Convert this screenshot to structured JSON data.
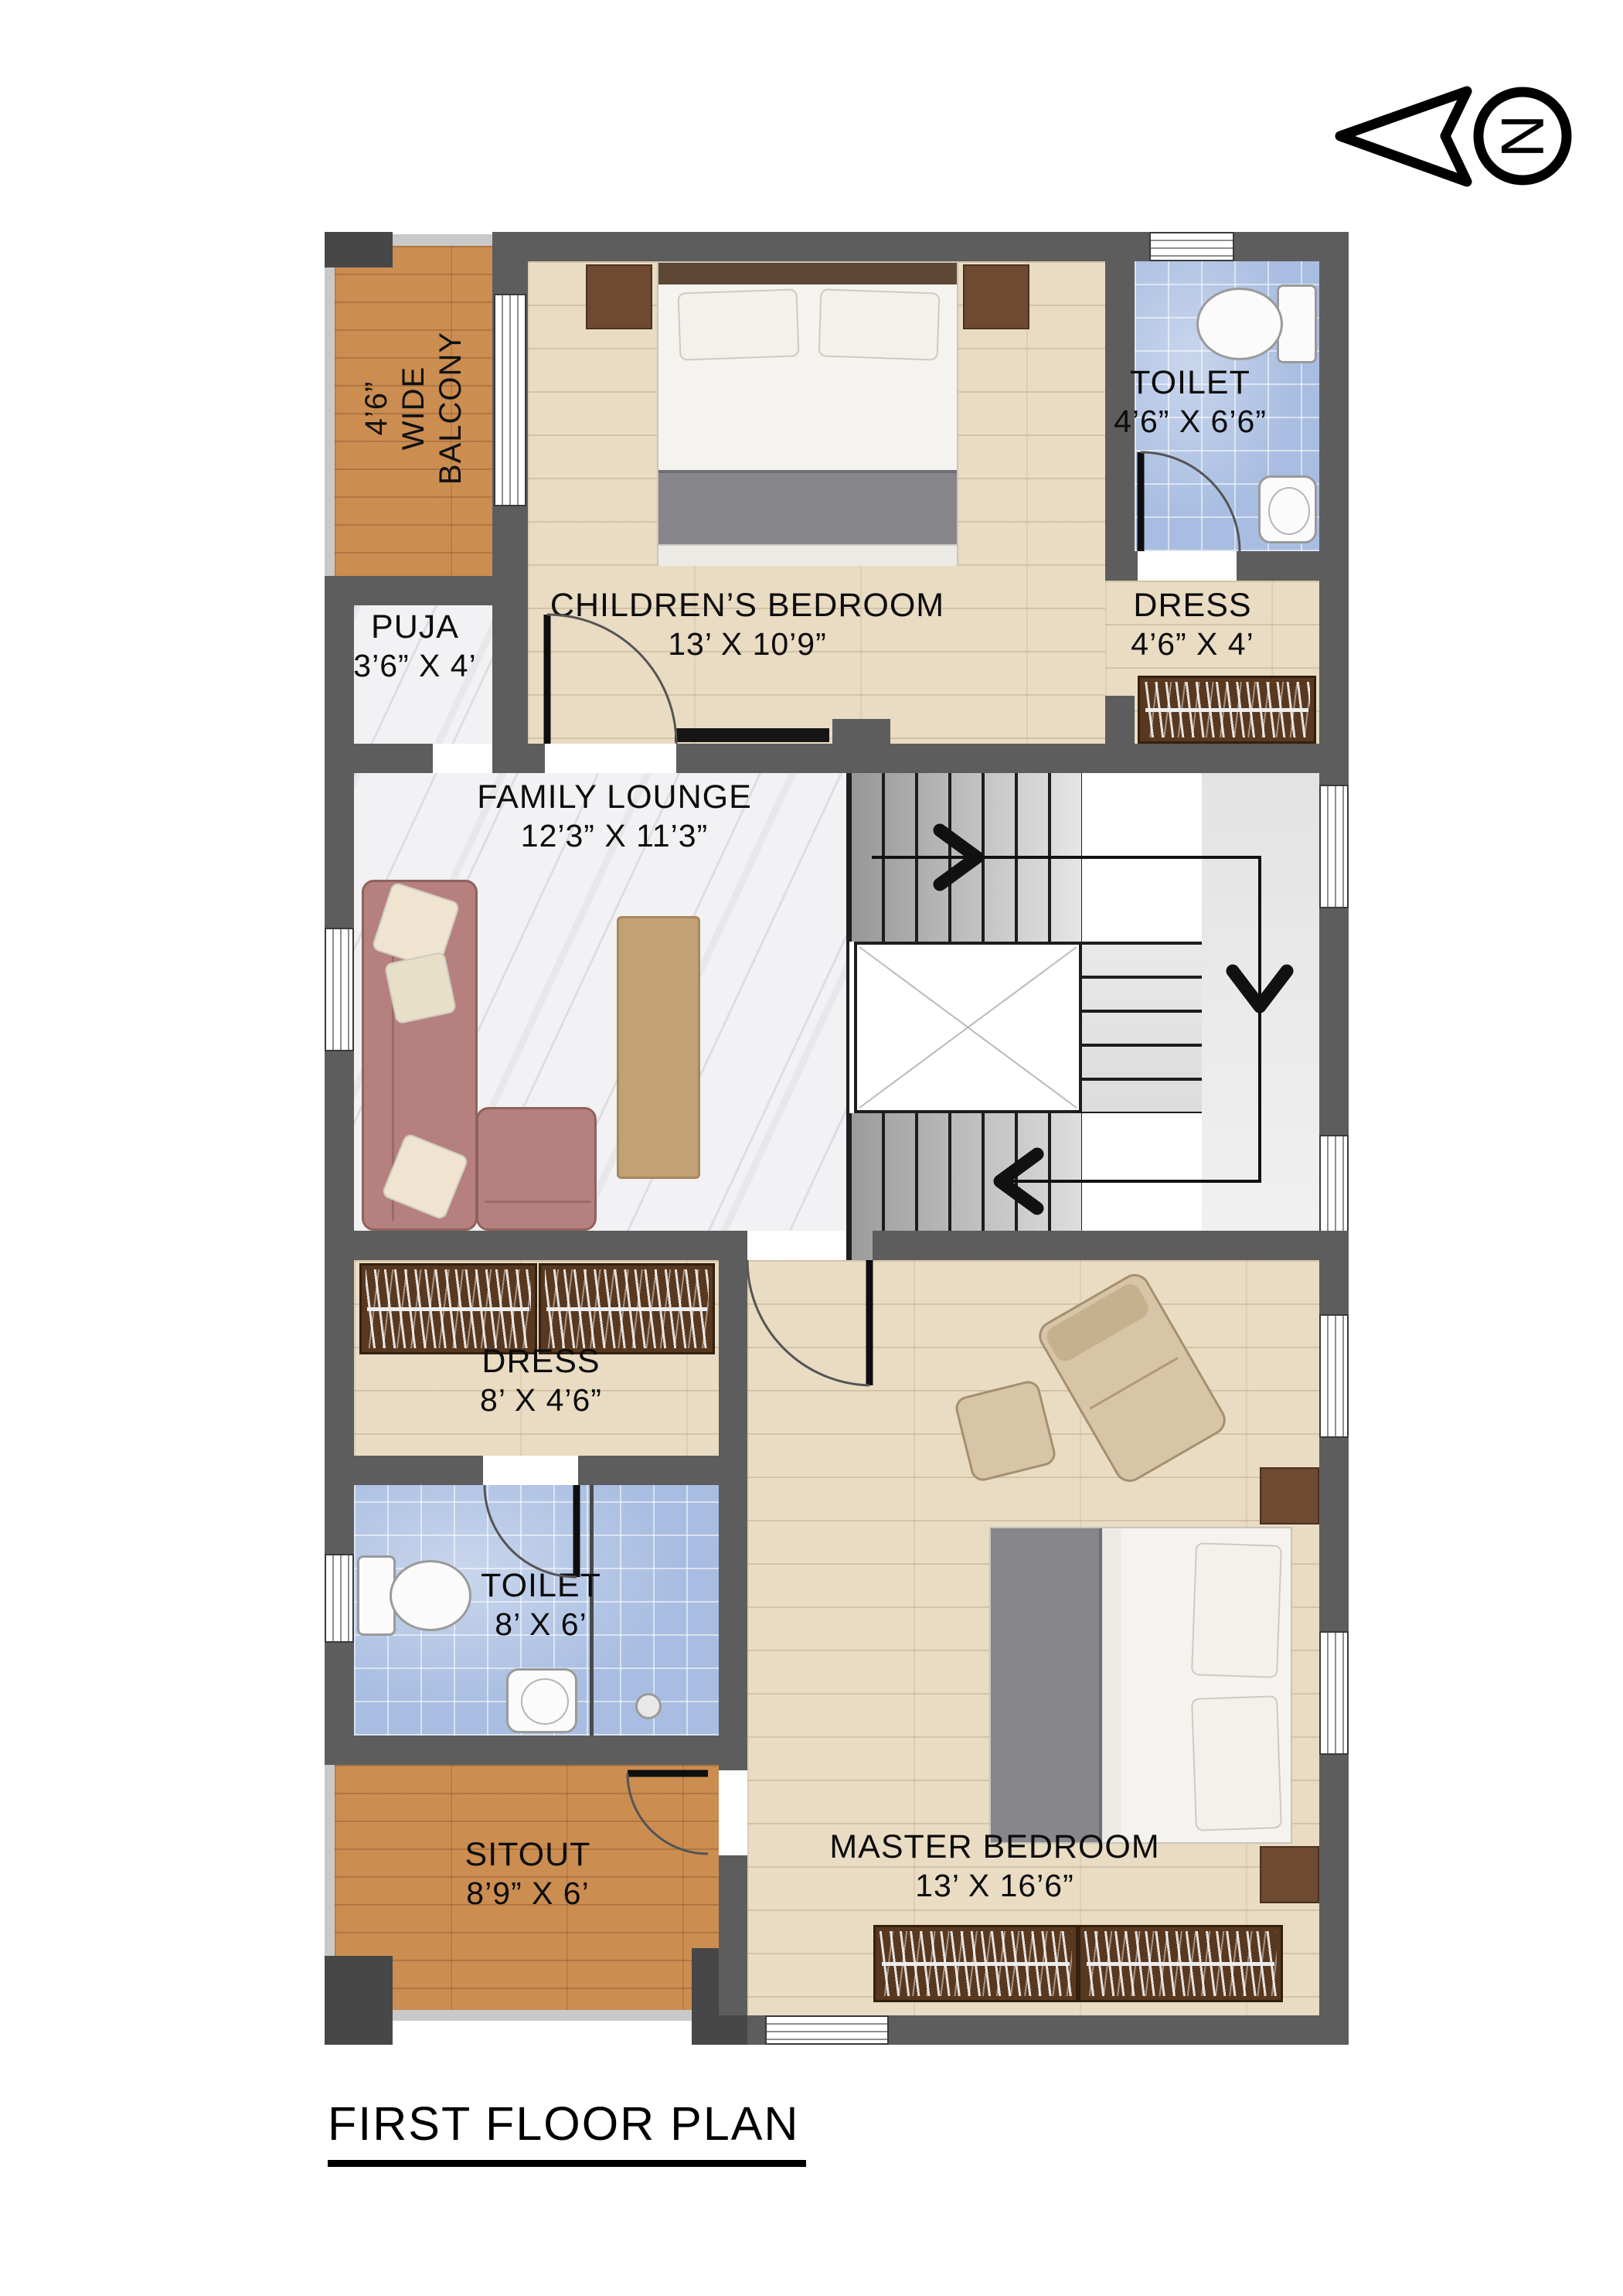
{
  "title": "FIRST FLOOR PLAN",
  "north": {
    "label": "N"
  },
  "rooms": [
    {
      "id": "balcony",
      "dims": "4’6”",
      "name_line1": "WIDE",
      "name_line2": "BALCONY",
      "name": "WIDE BALCONY",
      "floor": "warm-wood"
    },
    {
      "id": "puja",
      "name": "PUJA",
      "dims": "3’6” X 4’",
      "floor": "marble"
    },
    {
      "id": "childrens-bedroom",
      "name": "CHILDREN’S BEDROOM",
      "dims": "13’ X 10’9”",
      "floor": "light-wood"
    },
    {
      "id": "toilet-upper",
      "name": "TOILET",
      "dims": "4’6” X 6’6”",
      "floor": "blue-tile"
    },
    {
      "id": "dress-upper",
      "name": "DRESS",
      "dims": "4’6” X 4’",
      "floor": "light-wood"
    },
    {
      "id": "family-lounge",
      "name": "FAMILY LOUNGE",
      "dims": "12’3” X 11’3”",
      "floor": "marble"
    },
    {
      "id": "dress-lower",
      "name": "DRESS",
      "dims": "8’ X 4’6”",
      "floor": "light-wood"
    },
    {
      "id": "toilet-lower",
      "name": "TOILET",
      "dims": "8’ X 6’",
      "floor": "blue-tile"
    },
    {
      "id": "sitout",
      "name": "SITOUT",
      "dims": "8’9” X 6’",
      "floor": "warm-wood"
    },
    {
      "id": "master-bedroom",
      "name": "MASTER BEDROOM",
      "dims": "13’ X 16’6”",
      "floor": "light-wood"
    }
  ],
  "colors": {
    "wall": "#5d5d5d",
    "column": "#474747",
    "warm_wood": "#cb8d50",
    "light_wood": "#e9dcc3",
    "marble": "#f2f1f3",
    "blue_tile": "#a8bde1",
    "wardrobe": "#58381f",
    "sofa": "#b5807d",
    "rug": "#c2a175",
    "stair_gray": "#9b9b9b"
  }
}
